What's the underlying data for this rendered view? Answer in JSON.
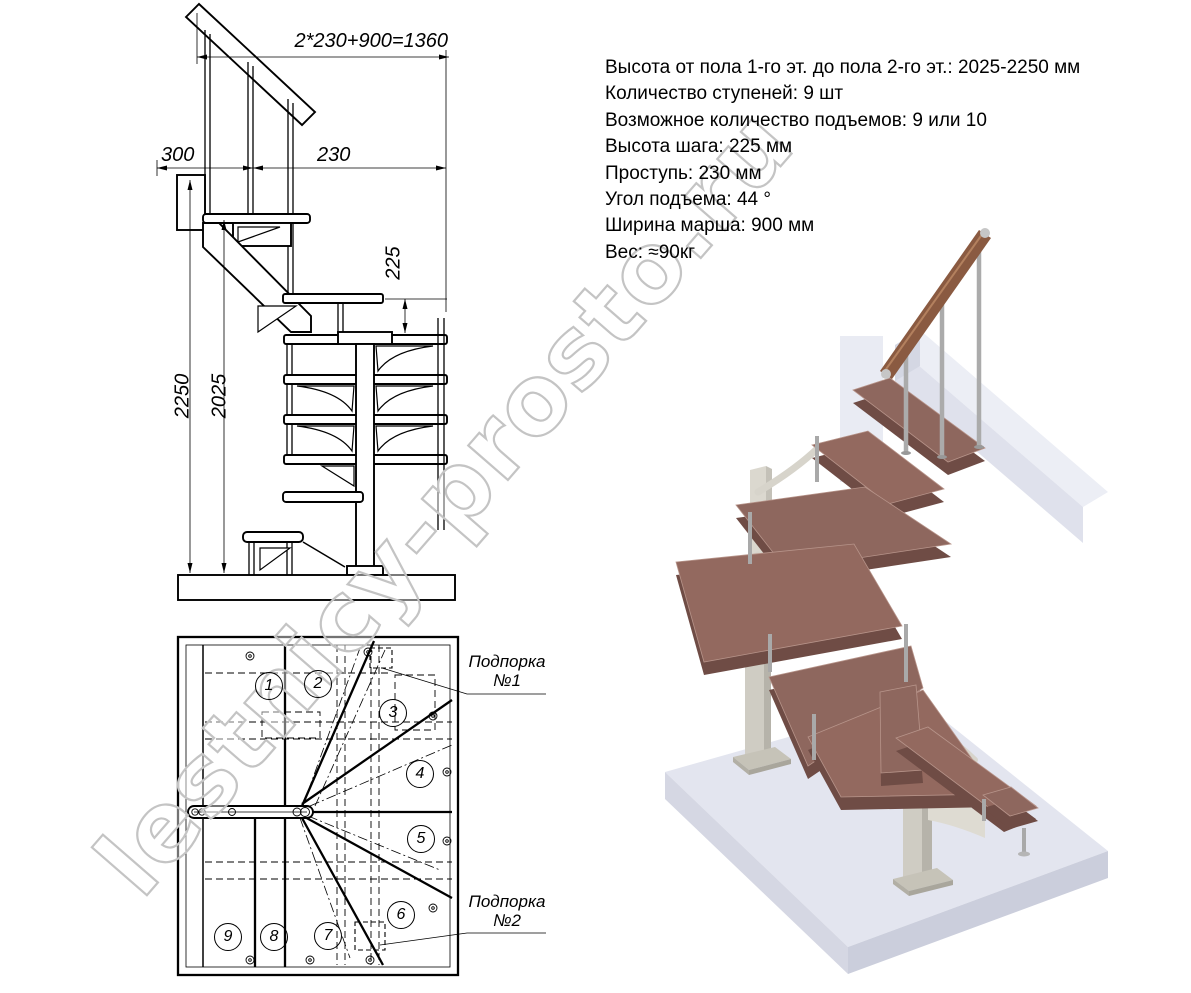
{
  "side_view": {
    "dim_total": "2*230+900=1360",
    "dim_left": "300",
    "dim_tread": "230",
    "dim_riser": "225",
    "dim_height_max": "2250",
    "dim_height_min": "2025"
  },
  "plan_view": {
    "step_numbers": [
      "1",
      "2",
      "3",
      "4",
      "5",
      "6",
      "7",
      "8",
      "9"
    ],
    "supports": [
      {
        "label": "Подпорка",
        "number": "№1"
      },
      {
        "label": "Подпорка",
        "number": "№2"
      }
    ]
  },
  "specs": {
    "lines": [
      "Высота от пола 1-го эт. до пола 2-го эт.: 2025-2250 мм",
      "Количество ступеней: 9 шт",
      "Возможное количество подъемов: 9 или 10",
      "Высота шага: 225 мм",
      "Проступь: 230 мм",
      "Угол подъема: 44 °",
      "Ширина марша: 900 мм",
      "Вес: ≈90кг"
    ]
  },
  "watermark": "lestnicy-prosto.ru",
  "colors": {
    "line": "#000000",
    "step_wood_top": "#8e675e",
    "step_wood_side": "#6f4c45",
    "rail_wood": "#8a5a41",
    "metal_baluster": "#a9a9a9",
    "column_metal": "#cfccc3",
    "floor_slab": "#e3e5ef",
    "wall_beam": "#dfe1ec",
    "watermark_gray": "#c4c4c4"
  }
}
